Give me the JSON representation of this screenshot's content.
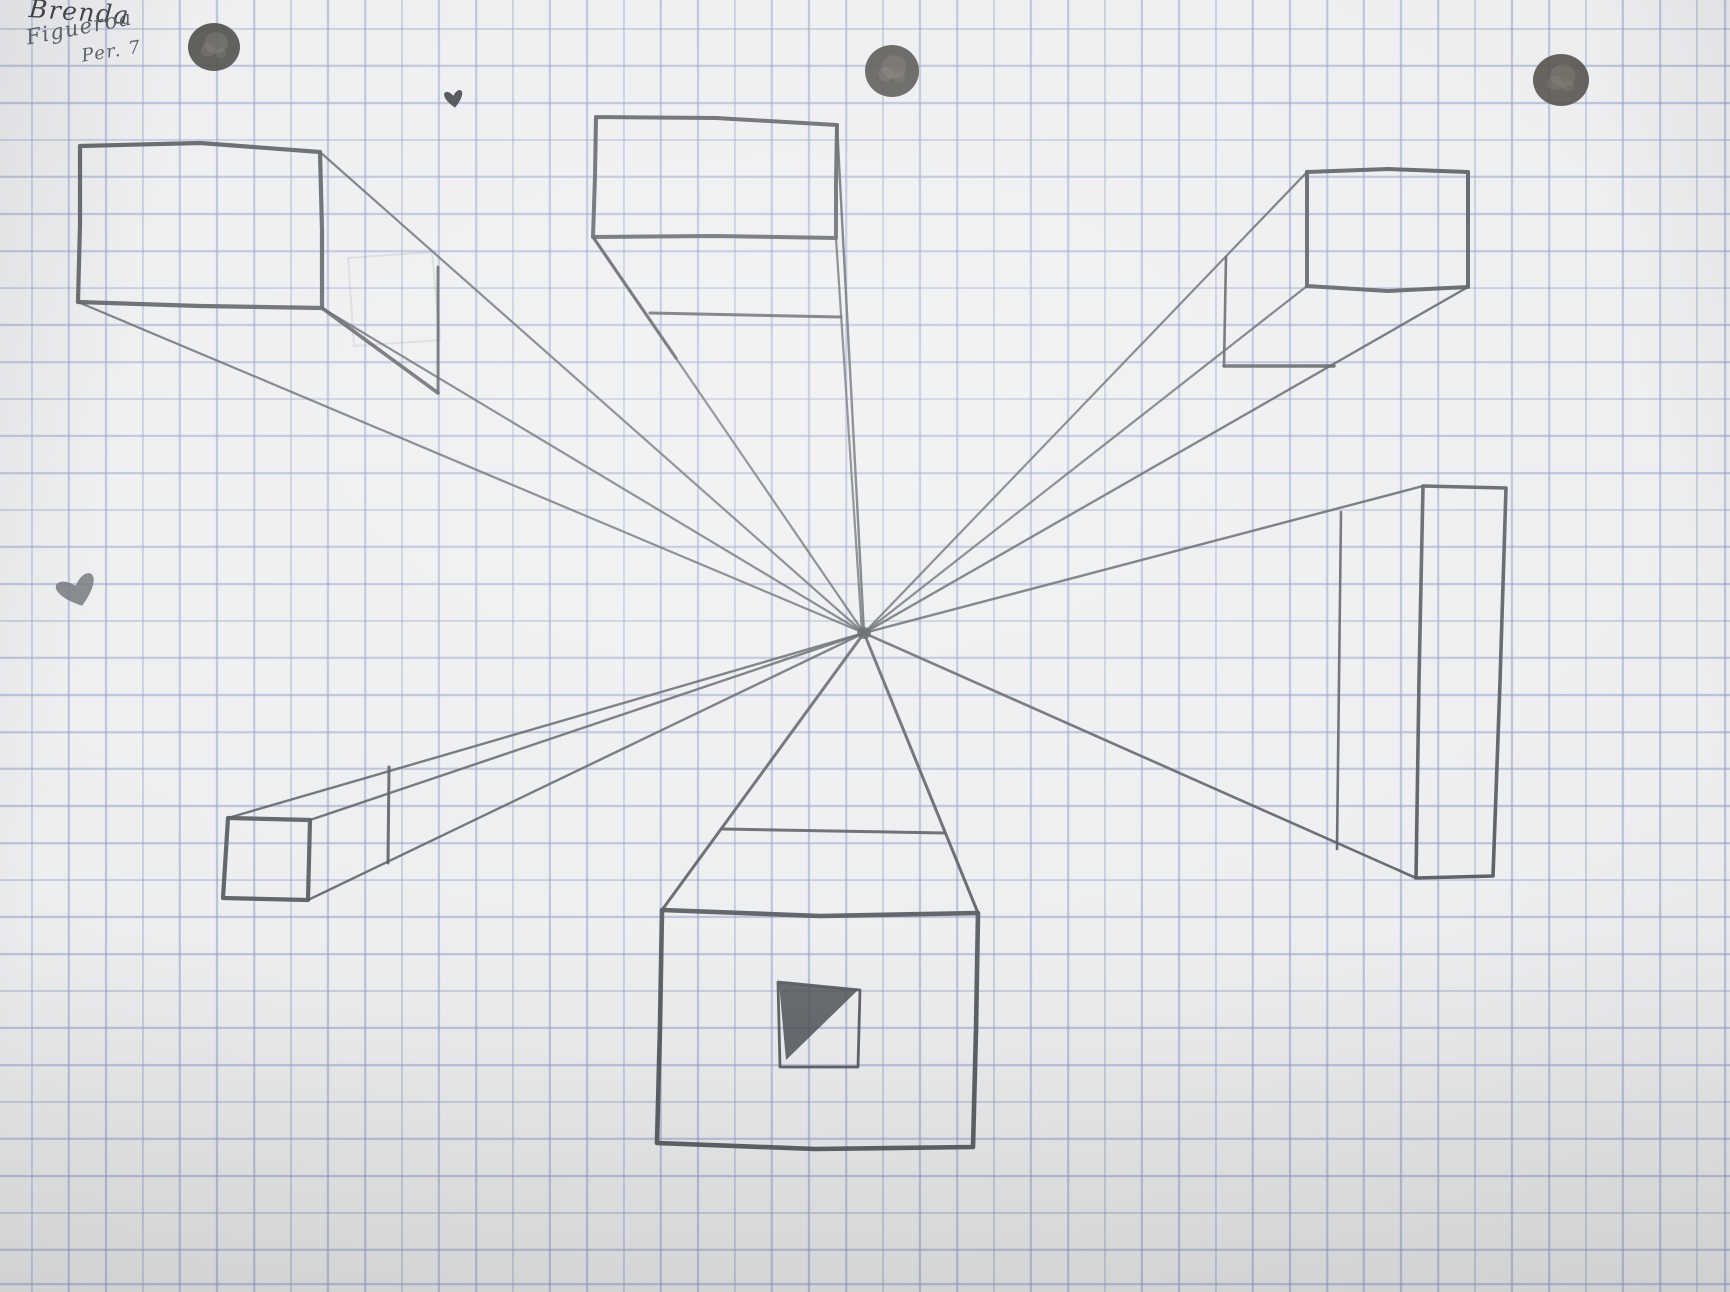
{
  "page": {
    "width": 1730,
    "height": 1292,
    "description": "Photograph of a hand-drawn one-point perspective exercise on blue graph paper"
  },
  "colors": {
    "paper": "#edeef0",
    "grid": "rgba(146,156,196,0.55)",
    "pencil": "#54575d",
    "pencil-dark": "#44464b"
  },
  "handwriting": {
    "line1": {
      "text": "Brenda",
      "x": 30,
      "y": -6,
      "size": 25,
      "rot": 4,
      "color": "#3f4146"
    },
    "line2": {
      "text": "Figueroa",
      "x": 24,
      "y": 26,
      "size": 21,
      "rot": -11,
      "color": "#595c62"
    },
    "line3": {
      "text": "Per. 7",
      "x": 80,
      "y": 46,
      "size": 18,
      "rot": -9,
      "color": "#595c62"
    }
  },
  "drawing": {
    "vanishing_point": {
      "x": 864,
      "y": 633
    },
    "strokes": [
      {
        "name": "top-left-box-recede-top",
        "pts": [
          [
            320,
            152
          ],
          [
            864,
            633
          ]
        ],
        "w": 2.2,
        "o": 0.8
      },
      {
        "name": "top-left-box-recede-bottom-right",
        "pts": [
          [
            322,
            308
          ],
          [
            864,
            633
          ]
        ],
        "w": 2.2,
        "o": 0.8
      },
      {
        "name": "top-left-box-recede-bottom-left",
        "pts": [
          [
            78,
            302
          ],
          [
            864,
            633
          ]
        ],
        "w": 2.2,
        "o": 0.8
      },
      {
        "name": "top-left-box-edge-dark",
        "pts": [
          [
            322,
            308
          ],
          [
            438,
            393
          ]
        ],
        "w": 3.6,
        "o": 0.9
      },
      {
        "name": "top-left-box-back-edge",
        "pts": [
          [
            438,
            267
          ],
          [
            438,
            393
          ]
        ],
        "w": 2.8,
        "o": 0.9
      },
      {
        "name": "top-left-box-erased-ghost",
        "pts": [
          [
            348,
            258
          ],
          [
            432,
            252
          ],
          [
            440,
            340
          ],
          [
            354,
            346
          ],
          [
            348,
            258
          ]
        ],
        "w": 2,
        "o": 0.13
      },
      {
        "name": "top-left-box-front",
        "pts": [
          [
            80,
            146
          ],
          [
            200,
            143
          ],
          [
            320,
            152
          ],
          [
            322,
            230
          ],
          [
            322,
            308
          ],
          [
            200,
            306
          ],
          [
            78,
            302
          ],
          [
            80,
            224
          ],
          [
            80,
            146
          ]
        ],
        "w": 4.2,
        "o": 0.93
      },
      {
        "name": "top-center-box-recede-bottom-left",
        "pts": [
          [
            593,
            237
          ],
          [
            864,
            633
          ]
        ],
        "w": 2.2,
        "o": 0.8
      },
      {
        "name": "top-center-box-recede-bl-dark",
        "pts": [
          [
            593,
            237
          ],
          [
            676,
            358
          ]
        ],
        "w": 3.2,
        "o": 0.9
      },
      {
        "name": "top-center-box-recede-top-right",
        "pts": [
          [
            837,
            125
          ],
          [
            864,
            633
          ]
        ],
        "w": 2.4,
        "o": 0.85
      },
      {
        "name": "top-center-box-recede-bottom-right",
        "pts": [
          [
            836,
            238
          ],
          [
            862,
            633
          ]
        ],
        "w": 2.2,
        "o": 0.8
      },
      {
        "name": "top-center-box-back-bottom-edge",
        "pts": [
          [
            650,
            313
          ],
          [
            841,
            317
          ]
        ],
        "w": 3,
        "o": 0.9
      },
      {
        "name": "top-center-box-front",
        "pts": [
          [
            596,
            117
          ],
          [
            716,
            118
          ],
          [
            837,
            125
          ],
          [
            836,
            182
          ],
          [
            836,
            238
          ],
          [
            714,
            236
          ],
          [
            593,
            237
          ],
          [
            595,
            176
          ],
          [
            596,
            117
          ]
        ],
        "w": 4,
        "o": 0.93
      },
      {
        "name": "top-right-box-recede-top-left",
        "pts": [
          [
            1307,
            172
          ],
          [
            864,
            633
          ]
        ],
        "w": 2.2,
        "o": 0.8
      },
      {
        "name": "top-right-box-recede-bottom-left",
        "pts": [
          [
            1307,
            286
          ],
          [
            864,
            633
          ]
        ],
        "w": 2.2,
        "o": 0.8
      },
      {
        "name": "top-right-box-recede-bottom-right",
        "pts": [
          [
            1468,
            287
          ],
          [
            864,
            633
          ]
        ],
        "w": 2.4,
        "o": 0.85
      },
      {
        "name": "top-right-box-back-vertical",
        "pts": [
          [
            1226,
            257
          ],
          [
            1224,
            366
          ]
        ],
        "w": 2.6,
        "o": 0.9
      },
      {
        "name": "top-right-box-back-bottom",
        "pts": [
          [
            1224,
            366
          ],
          [
            1334,
            366
          ]
        ],
        "w": 3.4,
        "o": 0.9
      },
      {
        "name": "top-right-box-front",
        "pts": [
          [
            1307,
            172
          ],
          [
            1388,
            169
          ],
          [
            1468,
            172
          ],
          [
            1468,
            287
          ],
          [
            1388,
            291
          ],
          [
            1307,
            286
          ],
          [
            1307,
            172
          ]
        ],
        "w": 4,
        "o": 0.93
      },
      {
        "name": "right-box-recede-top",
        "pts": [
          [
            1423,
            486
          ],
          [
            864,
            633
          ]
        ],
        "w": 2.4,
        "o": 0.85
      },
      {
        "name": "right-box-recede-bottom",
        "pts": [
          [
            1416,
            878
          ],
          [
            864,
            633
          ]
        ],
        "w": 2.6,
        "o": 0.88
      },
      {
        "name": "right-box-back-vertical",
        "pts": [
          [
            1341,
            512
          ],
          [
            1337,
            849
          ]
        ],
        "w": 2.6,
        "o": 0.88
      },
      {
        "name": "right-box-front",
        "pts": [
          [
            1423,
            486
          ],
          [
            1506,
            488
          ],
          [
            1500,
            682
          ],
          [
            1493,
            876
          ],
          [
            1416,
            878
          ],
          [
            1419,
            680
          ],
          [
            1423,
            486
          ]
        ],
        "w": 3.6,
        "o": 0.93
      },
      {
        "name": "bottom-left-box-recede-top-left",
        "pts": [
          [
            228,
            818
          ],
          [
            864,
            633
          ]
        ],
        "w": 2.4,
        "o": 0.85
      },
      {
        "name": "bottom-left-box-recede-top-right",
        "pts": [
          [
            310,
            820
          ],
          [
            864,
            633
          ]
        ],
        "w": 2.4,
        "o": 0.85
      },
      {
        "name": "bottom-left-box-recede-bottom-right",
        "pts": [
          [
            308,
            900
          ],
          [
            864,
            633
          ]
        ],
        "w": 2.4,
        "o": 0.85
      },
      {
        "name": "bottom-left-box-back-vertical",
        "pts": [
          [
            389,
            767
          ],
          [
            388,
            863
          ]
        ],
        "w": 3,
        "o": 0.9
      },
      {
        "name": "bottom-left-box-front",
        "pts": [
          [
            228,
            818
          ],
          [
            310,
            820
          ],
          [
            308,
            900
          ],
          [
            223,
            898
          ],
          [
            228,
            818
          ]
        ],
        "w": 4.2,
        "o": 0.93
      },
      {
        "name": "bottom-center-roof-left",
        "pts": [
          [
            662,
            910
          ],
          [
            864,
            633
          ]
        ],
        "w": 3,
        "o": 0.9
      },
      {
        "name": "bottom-center-roof-right",
        "pts": [
          [
            978,
            913
          ],
          [
            864,
            633
          ]
        ],
        "w": 3,
        "o": 0.9
      },
      {
        "name": "bottom-center-back-top",
        "pts": [
          [
            723,
            829
          ],
          [
            944,
            833
          ]
        ],
        "w": 3,
        "o": 0.9
      },
      {
        "name": "bottom-center-box-front",
        "pts": [
          [
            662,
            910
          ],
          [
            820,
            916
          ],
          [
            978,
            913
          ],
          [
            976,
            1030
          ],
          [
            973,
            1147
          ],
          [
            815,
            1149
          ],
          [
            657,
            1143
          ],
          [
            660,
            1026
          ],
          [
            662,
            910
          ]
        ],
        "w": 4.6,
        "o": 0.95
      },
      {
        "name": "bottom-center-inner-square",
        "pts": [
          [
            778,
            982
          ],
          [
            860,
            990
          ],
          [
            858,
            1067
          ],
          [
            780,
            1067
          ],
          [
            778,
            982
          ]
        ],
        "w": 2.8,
        "o": 0.92
      }
    ],
    "fills": [
      {
        "name": "inner-square-shading-triangle",
        "pts": [
          [
            779,
            983
          ],
          [
            858,
            990
          ],
          [
            786,
            1060
          ]
        ],
        "color": "#4e5156",
        "o": 0.85
      }
    ],
    "hearts": [
      {
        "name": "small-heart-doodle",
        "cx": 454,
        "cy": 100,
        "w": 26,
        "h": 24,
        "rot": -8,
        "color": "#3c3e42",
        "o": 0.95
      },
      {
        "name": "large-heart-doodle",
        "cx": 78,
        "cy": 593,
        "w": 56,
        "h": 42,
        "rot": -18,
        "color": "#6b6e74",
        "o": 0.85
      }
    ],
    "dots": [
      {
        "name": "marker-dot-left",
        "cx": 214,
        "cy": 47,
        "rx": 26,
        "ry": 24,
        "color": "#4b4a47",
        "o": 0.92
      },
      {
        "name": "marker-dot-center",
        "cx": 892,
        "cy": 71,
        "rx": 27,
        "ry": 26,
        "color": "#504e4b",
        "o": 0.92
      },
      {
        "name": "marker-dot-right",
        "cx": 1561,
        "cy": 80,
        "rx": 28,
        "ry": 26,
        "color": "#53504b",
        "o": 0.9
      },
      {
        "name": "vanishing-point-smudge",
        "cx": 864,
        "cy": 633,
        "rx": 7,
        "ry": 6,
        "color": "#4e5156",
        "o": 0.8
      }
    ]
  }
}
